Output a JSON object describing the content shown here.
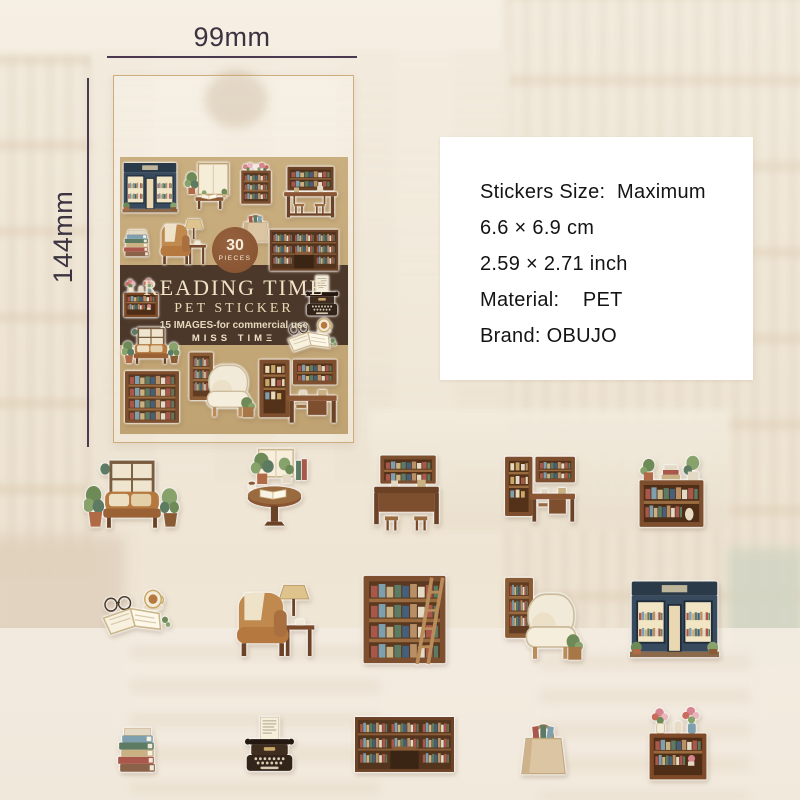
{
  "annotations": {
    "width_label": "99mm",
    "height_label": "144mm"
  },
  "package": {
    "badge": {
      "count": "30",
      "unit": "PIECES"
    },
    "title": "READING TIME",
    "subtitle": "PET STICKER",
    "usage_note": "15 IMAGES-for commercial use",
    "brand_logo": "MISS TIMΞ"
  },
  "spec_panel": {
    "lines": [
      "Stickers Size:  Maximum",
      "6.6 × 6.9 cm",
      "2.59 × 2.71 inch",
      "Material:    PET",
      "Brand: OBUJO"
    ]
  },
  "stickers": {
    "cover": [
      "bookstore-front",
      "reading-nook-window",
      "flower-top-bookshelf",
      "study-desk-hutch",
      "book-stack",
      "armchair-with-lamp",
      "book-tote-bag",
      "library-shelf-wall",
      "mini-flower-bookshelf",
      "vintage-typewriter",
      "coffee-and-open-book",
      "window-seat-sofa",
      "tall-bookshelf",
      "cream-armchair",
      "corner-study-desk"
    ],
    "sheet_rows": [
      [
        "window-seat-reading-corner",
        "reading-table-with-plants",
        "library-study-desk",
        "corner-study-desk",
        "plant-top-bookshelf"
      ],
      [
        "open-book-glasses-coffee",
        "armchair-with-lamp",
        "ladder-bookshelf",
        "cream-armchair-with-shelf",
        "bookstore-front"
      ],
      [
        "book-stack",
        "vintage-typewriter",
        "library-counter-wall",
        "book-tote-bag",
        "flower-vase-bookshelf"
      ]
    ]
  },
  "colors": {
    "cover_tan": "#c4a879",
    "band_brown": "#4b382a",
    "badge_brown": "#8d5a3a",
    "title_cream": "#f0e4c6",
    "panel_bg": "#ffffff",
    "dimension_ink": "#3b3340"
  }
}
